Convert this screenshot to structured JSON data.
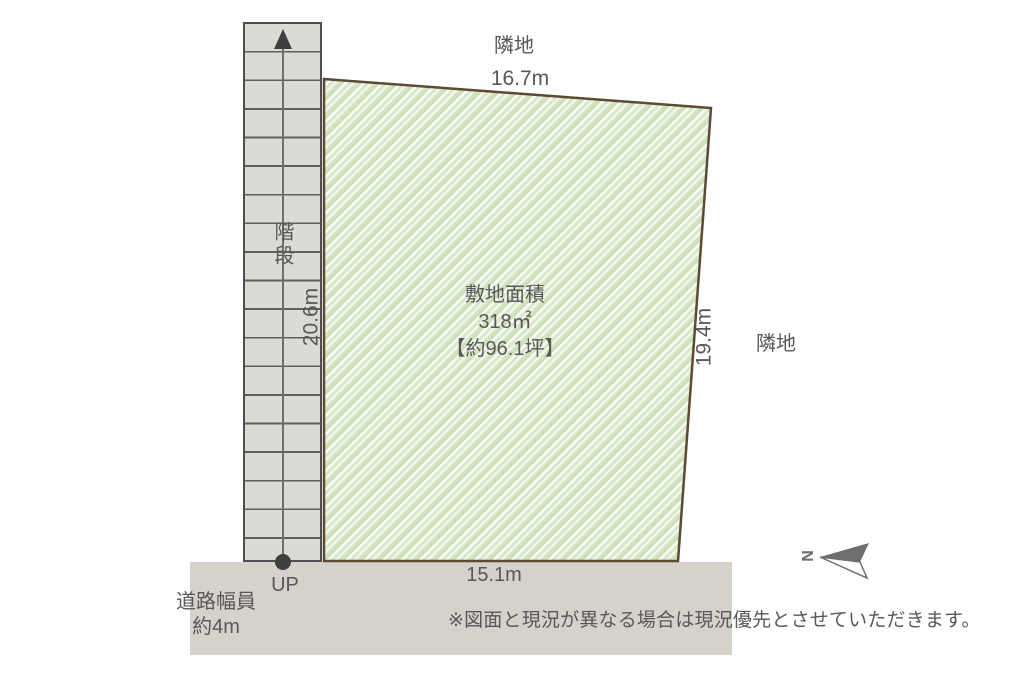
{
  "plot": {
    "area_title": "敷地面積",
    "area_value": "318㎡",
    "area_tsubo": "【約96.1坪】",
    "dim_top": "16.7m",
    "dim_bottom": "15.1m",
    "dim_left": "20.6m",
    "dim_right": "19.4m"
  },
  "labels": {
    "adjacent_top": "隣地",
    "adjacent_right": "隣地",
    "stairs": "階段",
    "up": "UP",
    "road_width_line1": "道路幅員",
    "road_width_line2": "約4m",
    "north": "N"
  },
  "footer": {
    "disclaimer": "※図面と現況が異なる場合は現況優先とさせていただきます。"
  },
  "colors": {
    "hatch_base": "#e7f0dd",
    "hatch_green": "#c9dfb5",
    "plot_border": "#5d4a33",
    "stairs_fill": "#dcdad5",
    "stairs_border": "#4f4f4f",
    "road_fill": "#d5d2cb",
    "text": "#595757",
    "marker": "#3f3f3f",
    "compass": "#6e6e6e"
  }
}
